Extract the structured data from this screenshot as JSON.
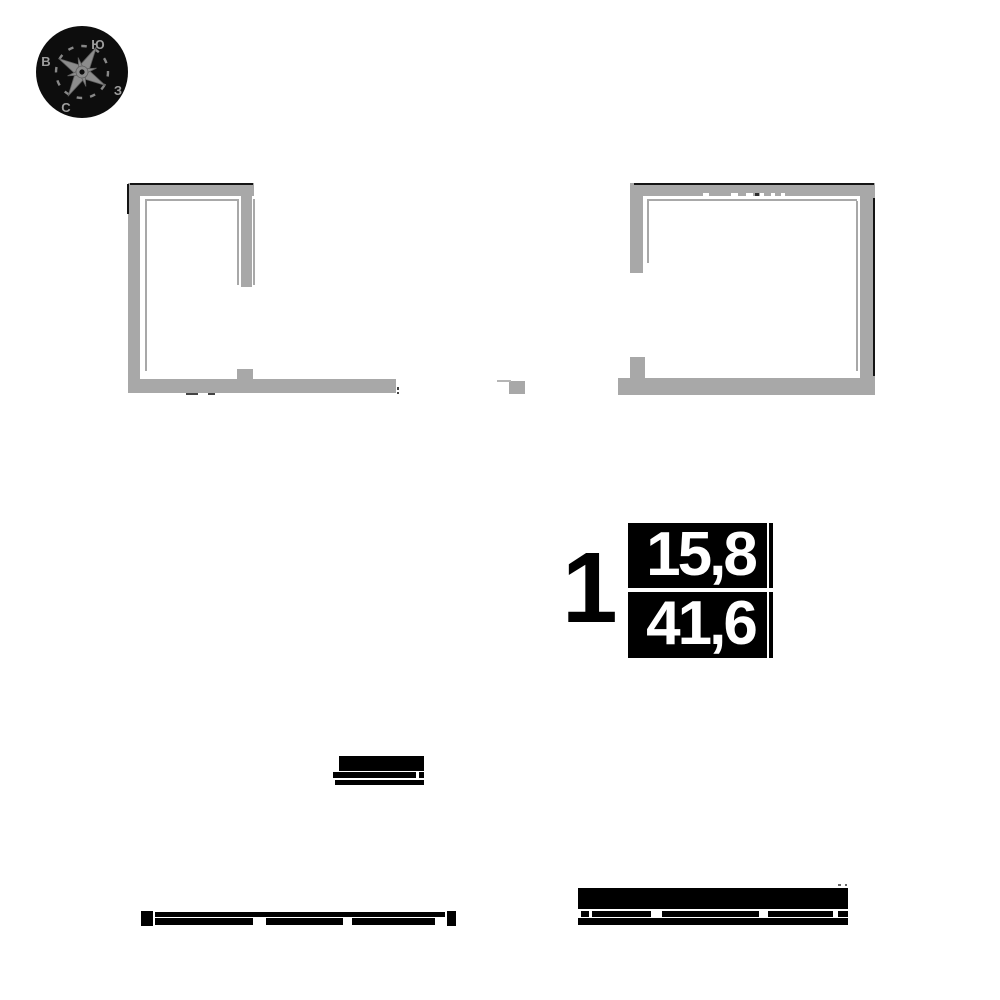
{
  "canvas": {
    "width": 1000,
    "height": 1000,
    "background": "#ffffff"
  },
  "compass": {
    "circle_color": "#0d0d0d",
    "star_color": "#8c8c8c",
    "letter_color": "#9d9d9d",
    "letters": {
      "south": "Ю",
      "east": "В",
      "west": "З",
      "north": "С"
    }
  },
  "unit": {
    "number": "1",
    "area_top": "15,8",
    "area_bottom": "41,6",
    "box_color": "#000000",
    "text_color": "#ffffff"
  },
  "plan": {
    "wall_color": "#a8a8a8",
    "edge_color": "#141414",
    "fragment_color": "#000000",
    "rects": [
      {
        "n": "left-room-top-wall",
        "x": 128,
        "y": 183,
        "w": 126,
        "h": 13,
        "c": "#a8a8a8"
      },
      {
        "n": "left-room-top-wall-edge",
        "x": 130,
        "y": 183,
        "w": 123,
        "h": 2,
        "c": "#141414"
      },
      {
        "n": "left-room-left-wall",
        "x": 128,
        "y": 196,
        "w": 12,
        "h": 196,
        "c": "#a8a8a8"
      },
      {
        "n": "left-room-left-wall-edge",
        "x": 127,
        "y": 184,
        "w": 2,
        "h": 30,
        "c": "#141414"
      },
      {
        "n": "left-room-inner-line-top",
        "x": 145,
        "y": 199,
        "w": 92,
        "h": 2,
        "c": "#a8a8a8"
      },
      {
        "n": "left-room-inner-line-left",
        "x": 145,
        "y": 201,
        "w": 2,
        "h": 170,
        "c": "#a8a8a8"
      },
      {
        "n": "left-room-partition-wall",
        "x": 241,
        "y": 196,
        "w": 11,
        "h": 91,
        "c": "#a8a8a8"
      },
      {
        "n": "left-room-partition-line-left",
        "x": 237,
        "y": 199,
        "w": 2,
        "h": 86,
        "c": "#a8a8a8"
      },
      {
        "n": "left-room-partition-line-right",
        "x": 253,
        "y": 199,
        "w": 2,
        "h": 86,
        "c": "#a8a8a8"
      },
      {
        "n": "left-room-bottom-wall",
        "x": 128,
        "y": 379,
        "w": 268,
        "h": 14,
        "c": "#a8a8a8"
      },
      {
        "n": "left-room-door-stub",
        "x": 237,
        "y": 369,
        "w": 16,
        "h": 10,
        "c": "#a8a8a8"
      },
      {
        "n": "left-room-mark",
        "x": 186,
        "y": 393,
        "w": 12,
        "h": 2,
        "c": "#444444"
      },
      {
        "n": "left-room-mark",
        "x": 208,
        "y": 393,
        "w": 7,
        "h": 2,
        "c": "#444444"
      },
      {
        "n": "left-room-mark",
        "x": 397,
        "y": 387,
        "w": 2,
        "h": 3,
        "c": "#444444"
      },
      {
        "n": "left-room-mark",
        "x": 397,
        "y": 392,
        "w": 2,
        "h": 2,
        "c": "#444444"
      },
      {
        "n": "right-room-top-wall",
        "x": 630,
        "y": 183,
        "w": 245,
        "h": 13,
        "c": "#a8a8a8"
      },
      {
        "n": "right-room-top-wall-edge",
        "x": 634,
        "y": 183,
        "w": 240,
        "h": 2,
        "c": "#141414"
      },
      {
        "n": "right-room-left-wall",
        "x": 630,
        "y": 196,
        "w": 13,
        "h": 77,
        "c": "#a8a8a8"
      },
      {
        "n": "right-room-left-stub",
        "x": 630,
        "y": 357,
        "w": 15,
        "h": 21,
        "c": "#a8a8a8"
      },
      {
        "n": "right-room-right-wall",
        "x": 860,
        "y": 196,
        "w": 15,
        "h": 182,
        "c": "#a8a8a8"
      },
      {
        "n": "right-room-right-wall-edge",
        "x": 873,
        "y": 198,
        "w": 2,
        "h": 178,
        "c": "#141414"
      },
      {
        "n": "right-room-bottom-wall",
        "x": 618,
        "y": 378,
        "w": 257,
        "h": 17,
        "c": "#a8a8a8"
      },
      {
        "n": "right-room-inner-line-top",
        "x": 647,
        "y": 199,
        "w": 210,
        "h": 2,
        "c": "#a8a8a8"
      },
      {
        "n": "right-room-inner-line-left",
        "x": 647,
        "y": 201,
        "w": 2,
        "h": 62,
        "c": "#a8a8a8"
      },
      {
        "n": "right-room-inner-line-right",
        "x": 856,
        "y": 201,
        "w": 2,
        "h": 170,
        "c": "#a8a8a8"
      },
      {
        "n": "window-tick",
        "x": 703,
        "y": 193,
        "w": 6,
        "h": 3,
        "c": "#ffffff"
      },
      {
        "n": "window-tick",
        "x": 731,
        "y": 193,
        "w": 7,
        "h": 3,
        "c": "#ffffff"
      },
      {
        "n": "window-tick",
        "x": 746,
        "y": 193,
        "w": 7,
        "h": 3,
        "c": "#ffffff"
      },
      {
        "n": "window-tick-dark",
        "x": 755,
        "y": 193,
        "w": 4,
        "h": 3,
        "c": "#2e2e2e"
      },
      {
        "n": "window-tick",
        "x": 760,
        "y": 193,
        "w": 4,
        "h": 3,
        "c": "#ffffff"
      },
      {
        "n": "window-tick",
        "x": 771,
        "y": 193,
        "w": 4,
        "h": 3,
        "c": "#ffffff"
      },
      {
        "n": "window-tick",
        "x": 781,
        "y": 193,
        "w": 4,
        "h": 3,
        "c": "#ffffff"
      },
      {
        "n": "wall-fragment-block",
        "x": 509,
        "y": 381,
        "w": 16,
        "h": 13,
        "c": "#a8a8a8"
      },
      {
        "n": "wall-fragment-line",
        "x": 497,
        "y": 380,
        "w": 14,
        "h": 2,
        "c": "#b5b5b5"
      },
      {
        "n": "mid-bar-thick",
        "x": 339,
        "y": 756,
        "w": 85,
        "h": 15,
        "c": "#000000"
      },
      {
        "n": "mid-bar-thin",
        "x": 333,
        "y": 772,
        "w": 91,
        "h": 6,
        "c": "#000000"
      },
      {
        "n": "mid-bar-notch",
        "x": 416,
        "y": 772,
        "w": 3,
        "h": 6,
        "c": "#ffffff"
      },
      {
        "n": "mid-bar-thin",
        "x": 335,
        "y": 780,
        "w": 89,
        "h": 5,
        "c": "#000000"
      },
      {
        "n": "bottom-left-end-block",
        "x": 141,
        "y": 911,
        "w": 12,
        "h": 15,
        "c": "#000000"
      },
      {
        "n": "bottom-left-top-line",
        "x": 155,
        "y": 912,
        "w": 290,
        "h": 5,
        "c": "#000000"
      },
      {
        "n": "bottom-left-segment",
        "x": 155,
        "y": 918,
        "w": 98,
        "h": 7,
        "c": "#000000"
      },
      {
        "n": "bottom-left-segment",
        "x": 266,
        "y": 918,
        "w": 77,
        "h": 7,
        "c": "#000000"
      },
      {
        "n": "bottom-left-segment",
        "x": 352,
        "y": 918,
        "w": 83,
        "h": 7,
        "c": "#000000"
      },
      {
        "n": "bottom-left-end-block",
        "x": 447,
        "y": 911,
        "w": 9,
        "h": 15,
        "c": "#000000"
      },
      {
        "n": "bottom-right-thick-bar",
        "x": 578,
        "y": 888,
        "w": 270,
        "h": 21,
        "c": "#000000"
      },
      {
        "n": "bottom-right-segment",
        "x": 581,
        "y": 911,
        "w": 8,
        "h": 6,
        "c": "#000000"
      },
      {
        "n": "bottom-right-segment",
        "x": 592,
        "y": 911,
        "w": 59,
        "h": 6,
        "c": "#000000"
      },
      {
        "n": "bottom-right-segment",
        "x": 662,
        "y": 911,
        "w": 97,
        "h": 6,
        "c": "#000000"
      },
      {
        "n": "bottom-right-segment",
        "x": 768,
        "y": 911,
        "w": 65,
        "h": 6,
        "c": "#000000"
      },
      {
        "n": "bottom-right-segment",
        "x": 838,
        "y": 911,
        "w": 10,
        "h": 6,
        "c": "#000000"
      },
      {
        "n": "bottom-right-bottom-line",
        "x": 578,
        "y": 918,
        "w": 270,
        "h": 7,
        "c": "#000000"
      },
      {
        "n": "bottom-right-dot",
        "x": 838,
        "y": 884,
        "w": 3,
        "h": 2,
        "c": "#666666"
      },
      {
        "n": "bottom-right-dot",
        "x": 845,
        "y": 884,
        "w": 2,
        "h": 2,
        "c": "#666666"
      }
    ]
  }
}
